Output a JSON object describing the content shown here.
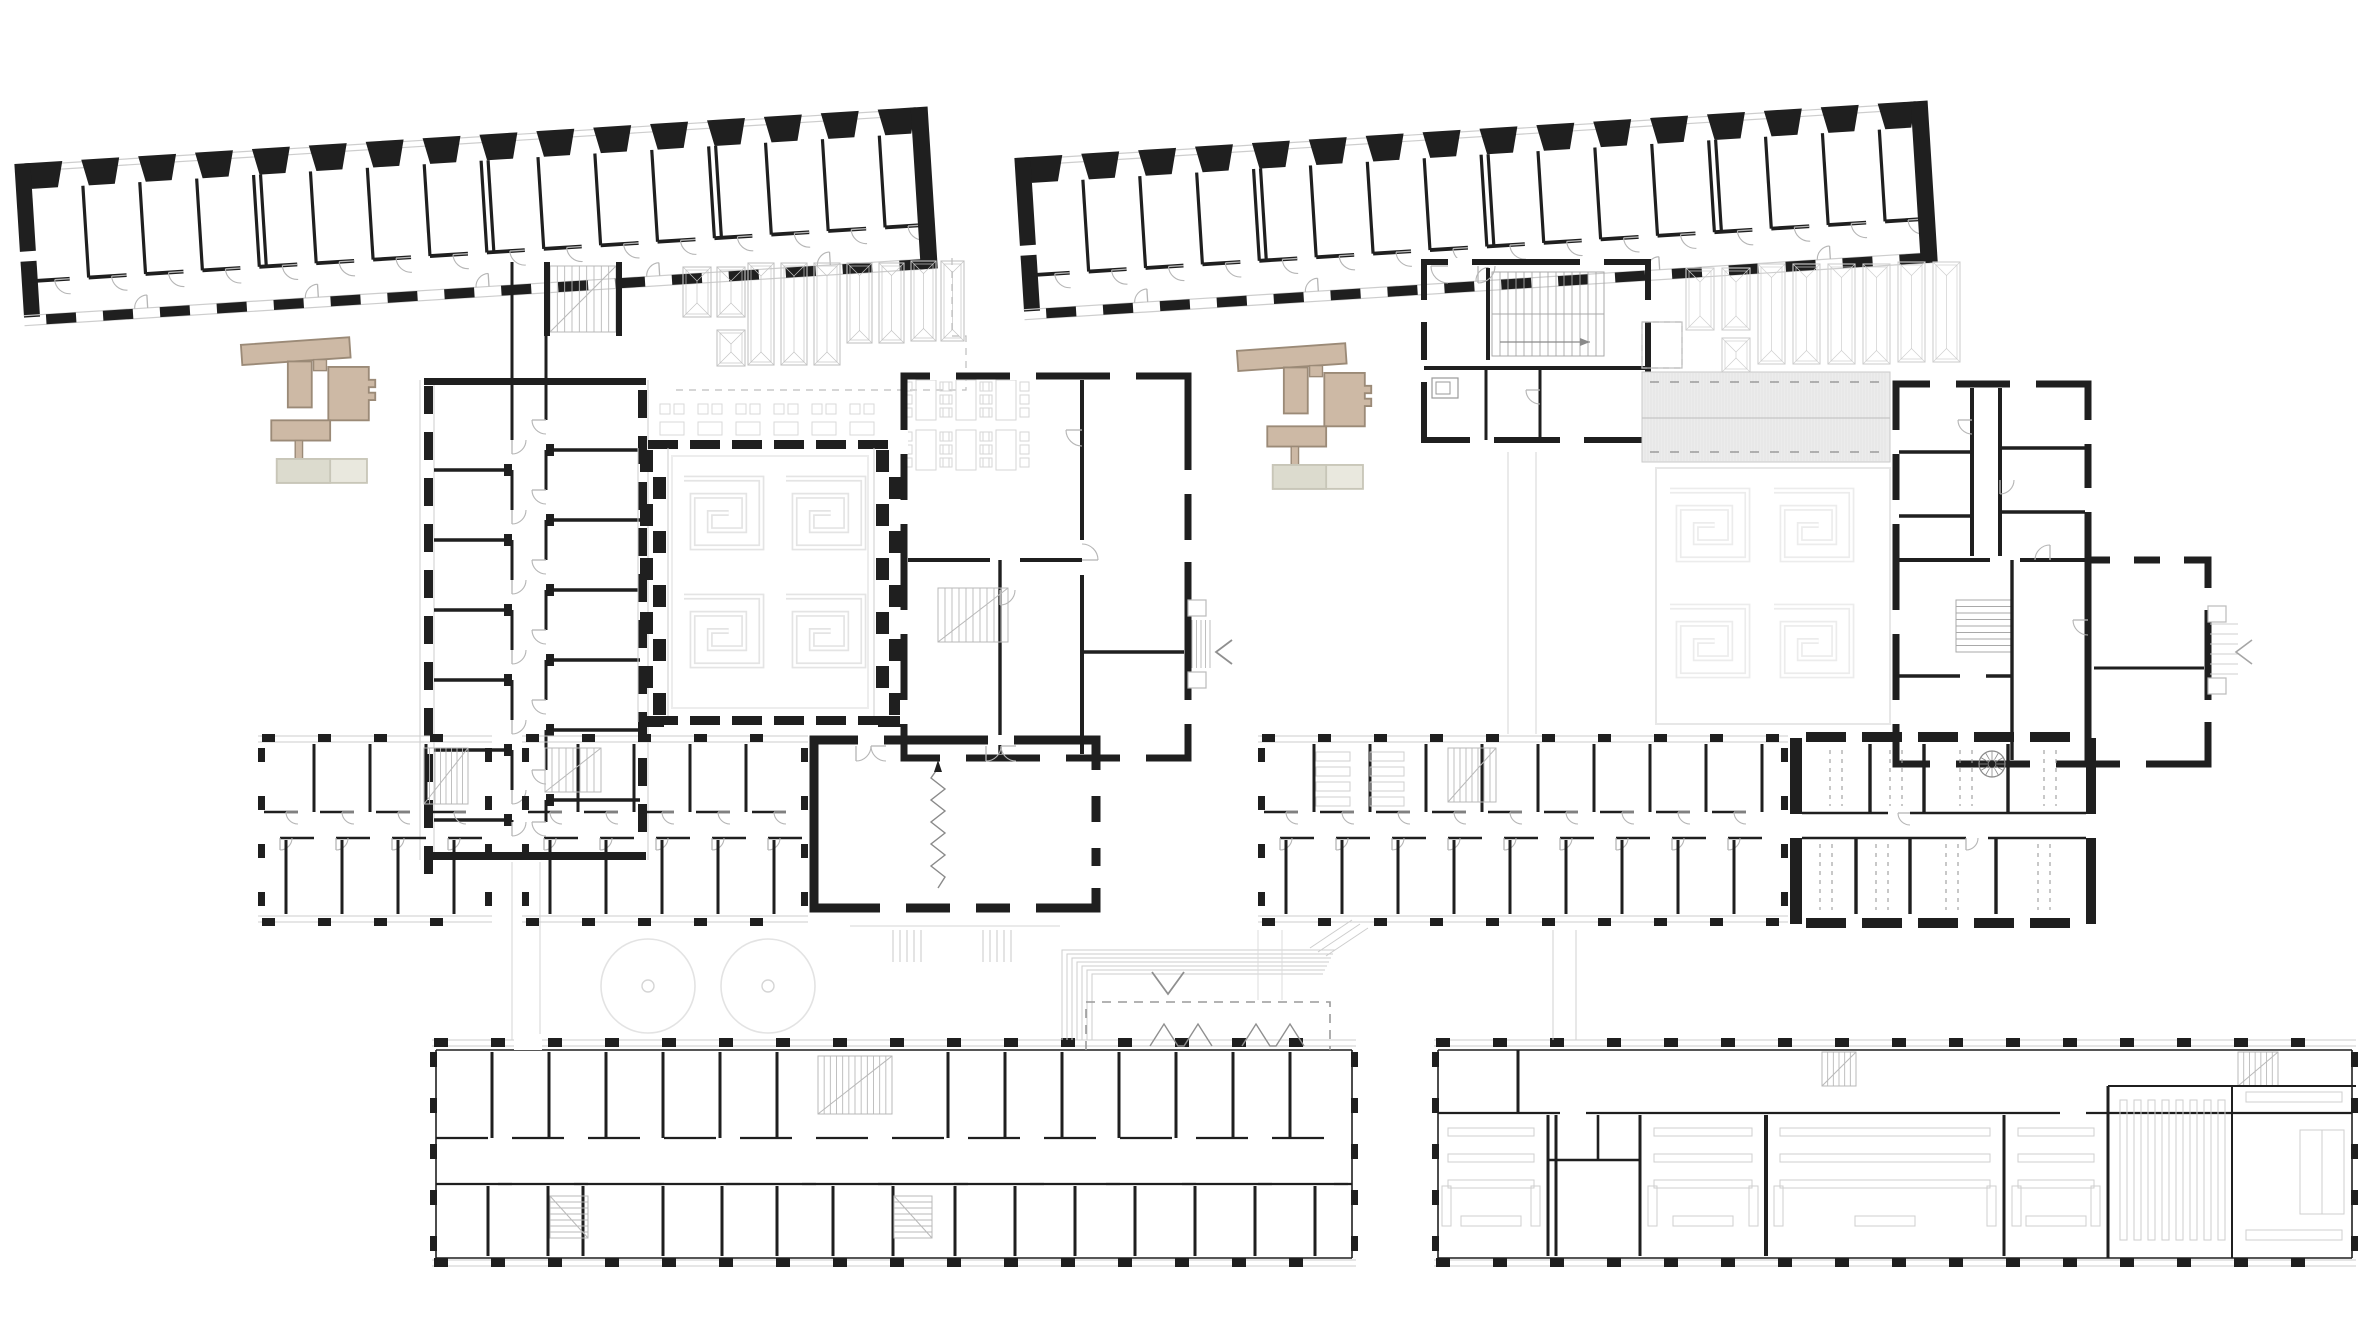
{
  "document": {
    "type": "architectural-floor-plan-sheet",
    "description": "Two building floor plans drawn side by side on a white sheet; left sheet shows the ground floor, right sheet shows the upper floor of the same school complex",
    "sheets": [
      {
        "id": "left-plan",
        "name": "ground-floor-plan",
        "position": "left"
      },
      {
        "id": "right-plan",
        "name": "upper-floor-plan",
        "position": "right"
      }
    ],
    "features": [
      "tilted-classroom-wing",
      "courtyard-hall-with-greek-key-floor",
      "skylight-roof-field",
      "hatched-roof-band",
      "double-loaded-corridor-wings",
      "assembly-hall-with-folding-partition",
      "site-key-locator-icon",
      "trees",
      "entrance-steps",
      "bench-furniture"
    ]
  },
  "symbols": {
    "entry_arrow_left_glyph": "<",
    "entry_arrow_down_glyph": "V",
    "partition_symbol": "zigzag-line-with-arrow",
    "stair_symbol": "parallel-tread-lines"
  },
  "colors": {
    "paper": "#ffffff",
    "ink": "#1f1f1f",
    "gray": "#8f8f8f",
    "mid": "#b5b5b5",
    "light": "#cdcdcd",
    "faint": "#e6e6e6",
    "hatch_fill": "#ececec",
    "hatch_line": "#dfdfdf",
    "beige": "#cdb9a5",
    "beige_stroke": "#9b8a77",
    "beige_light": "#e9e8de",
    "beige_light_stroke": "#c8c6b8",
    "beige_dim": "#dcdbce"
  }
}
